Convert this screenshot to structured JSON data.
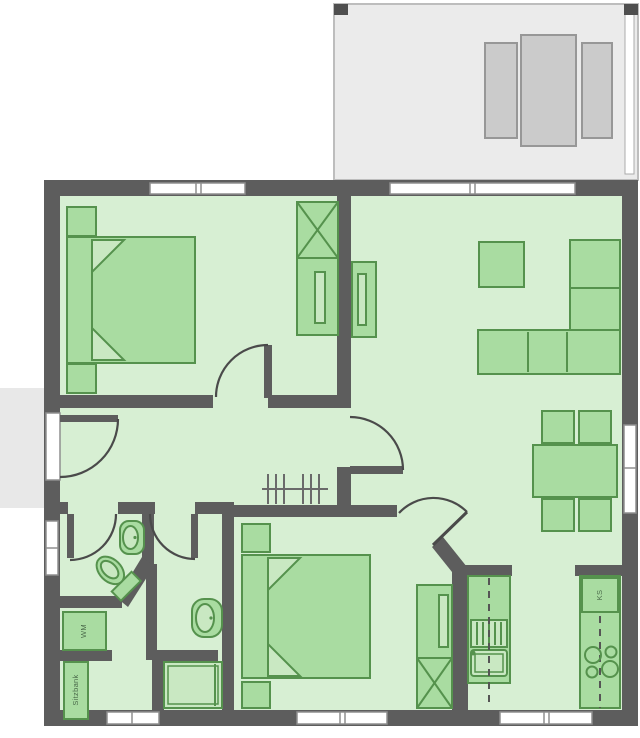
{
  "plan": {
    "labels": {
      "washing_machine": "WM",
      "bench": "Sitzbank",
      "fridge": "KS"
    },
    "colors": {
      "wall": "#5d5d5d",
      "floor": "#d7efd3",
      "furniture_fill": "#a9dca1",
      "furniture_stroke": "#55924d",
      "furniture_light": "#c9e8c2",
      "terrace_fill": "#ebebeb",
      "terrace_furniture": "#cbcbcb",
      "window_fill": "#ffffff",
      "door_arc": "#4a4a4a",
      "label_text": "#4b6b4b"
    },
    "rooms": [
      "terrace",
      "bedroom-1",
      "living-dining",
      "hallway",
      "wc",
      "shower-room",
      "bedroom-2",
      "kitchen"
    ],
    "furniture": [
      "double-bed",
      "nightstand",
      "wardrobe",
      "sideboard",
      "coffee-table",
      "corner-sofa",
      "dining-table",
      "chair",
      "toilet",
      "wash-basin",
      "shower",
      "washing-machine",
      "bench",
      "fridge",
      "cooktop",
      "kitchen-sink",
      "dishwasher",
      "coat-rack"
    ]
  }
}
